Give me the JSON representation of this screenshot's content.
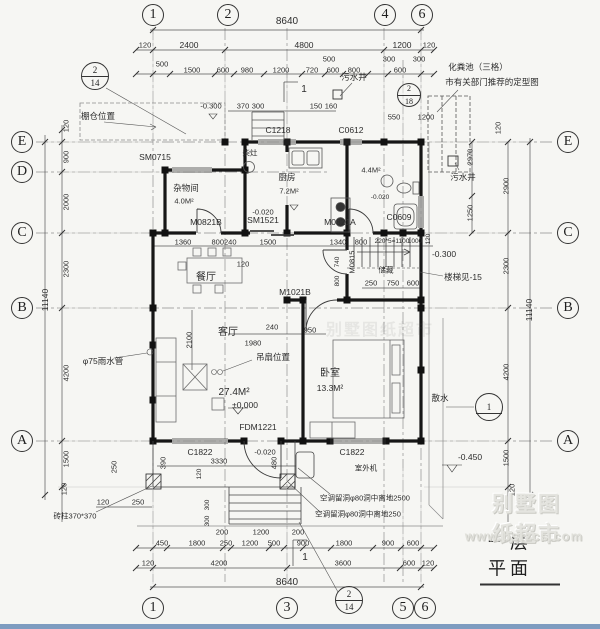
{
  "titleblock": {
    "title": "一层平面"
  },
  "watermark": {
    "brand": "别墅图纸超市",
    "url": "www.bstzcs.com"
  },
  "grid": {
    "top": [
      "1",
      "2",
      "4",
      "6"
    ],
    "bottom": [
      "1",
      "3",
      "5",
      "6"
    ],
    "left": [
      "E",
      "D",
      "C",
      "B",
      "A"
    ],
    "right": [
      "E",
      "C",
      "B",
      "A"
    ]
  },
  "details": {
    "tl": {
      "top": "2",
      "bottom": "14"
    },
    "tr": {
      "top": "2",
      "bottom": "18"
    },
    "b": {
      "top": "2",
      "bottom": "14"
    },
    "r": {
      "top": "1",
      "bottom": ""
    }
  },
  "rooms": {
    "storage": {
      "name": "杂物间",
      "area": "4.0M²"
    },
    "kitchen": {
      "name": "厨房",
      "area": "7.2M²",
      "stove_label": "柴灶",
      "elev": "-0.020"
    },
    "bath": {
      "area": "4.4M²",
      "elev": "-0.020"
    },
    "dining": {
      "name": "餐厅"
    },
    "living": {
      "name": "客厅",
      "area": "27.4M²",
      "elev": "±0.000",
      "fan_label": "吊扇位置"
    },
    "bedroom": {
      "name": "卧室",
      "area": "13.3M²"
    },
    "stair": {
      "note": "楼梯见-15",
      "elev": "-0.300",
      "closet": "储藏"
    }
  },
  "openings": {
    "sm0715": "SM0715",
    "c1218": "C1218",
    "c0612": "C0612",
    "m0821b": "M0821B",
    "sm1521": "SM1521",
    "m0821a": "M0821A",
    "c0609": "C0609",
    "m1021b": "M1021B",
    "m0815": "M0815",
    "fdm1221": "FDM1221",
    "c1822_l": "C1822",
    "c1822_r": "C1822"
  },
  "annotations": {
    "canopy": "棚仓位置",
    "septic_line1": "化粪池（三格）",
    "septic_line2": "市有关部门推荐的定型图",
    "sewage_well_top": "污水井",
    "sewage_well_right": "污水井",
    "rain_pipe": "φ75雨水管",
    "apron": "散水",
    "ac_unit": "室外机",
    "ac_hole_upper": "空调留洞φ80洞中离地2500",
    "ac_hole_lower": "空调留洞φ80洞中离地250",
    "brick_column": "砖柱370*370",
    "elev_outside": "-0.450",
    "step_mark": "1"
  },
  "dims": {
    "top1": "8640",
    "top2": [
      "120",
      "2400",
      "4800",
      "1200",
      "120"
    ],
    "top3": [
      "500",
      "1500",
      "600",
      "980",
      "1200",
      "720",
      "600",
      "800",
      "600"
    ],
    "top3b": [
      "500",
      "300",
      "300"
    ],
    "rear": [
      "-0.300",
      "370",
      "300",
      "150",
      "160",
      "550",
      "1200"
    ],
    "rowC": [
      "1360",
      "800240",
      "1500",
      "1340",
      "800",
      "220*5=1100",
      "1000"
    ],
    "left": [
      "120",
      "900",
      "2000",
      "2300",
      "4200",
      "1500"
    ],
    "left_total": "11140",
    "left_extra": [
      "250",
      "120"
    ],
    "right": [
      "120",
      "2970",
      "2900",
      "1250",
      "2300",
      "4200",
      "1500",
      "120"
    ],
    "right_total": "11140",
    "living": [
      "120",
      "2100",
      "1980",
      "240",
      "950",
      "740",
      "800"
    ],
    "stair": [
      "250",
      "750",
      "600",
      "120"
    ],
    "porch": [
      "390",
      "3330",
      "480",
      "120",
      "300",
      "300",
      "200",
      "1200",
      "200",
      "120",
      "250"
    ],
    "porch_elev": "-0.020",
    "bottom1": [
      "450",
      "1800",
      "250",
      "1200",
      "500",
      "900",
      "1800",
      "900",
      "600"
    ],
    "bottom2": [
      "120",
      "4200",
      "3600",
      "600",
      "120"
    ],
    "bottom3": "8640"
  }
}
